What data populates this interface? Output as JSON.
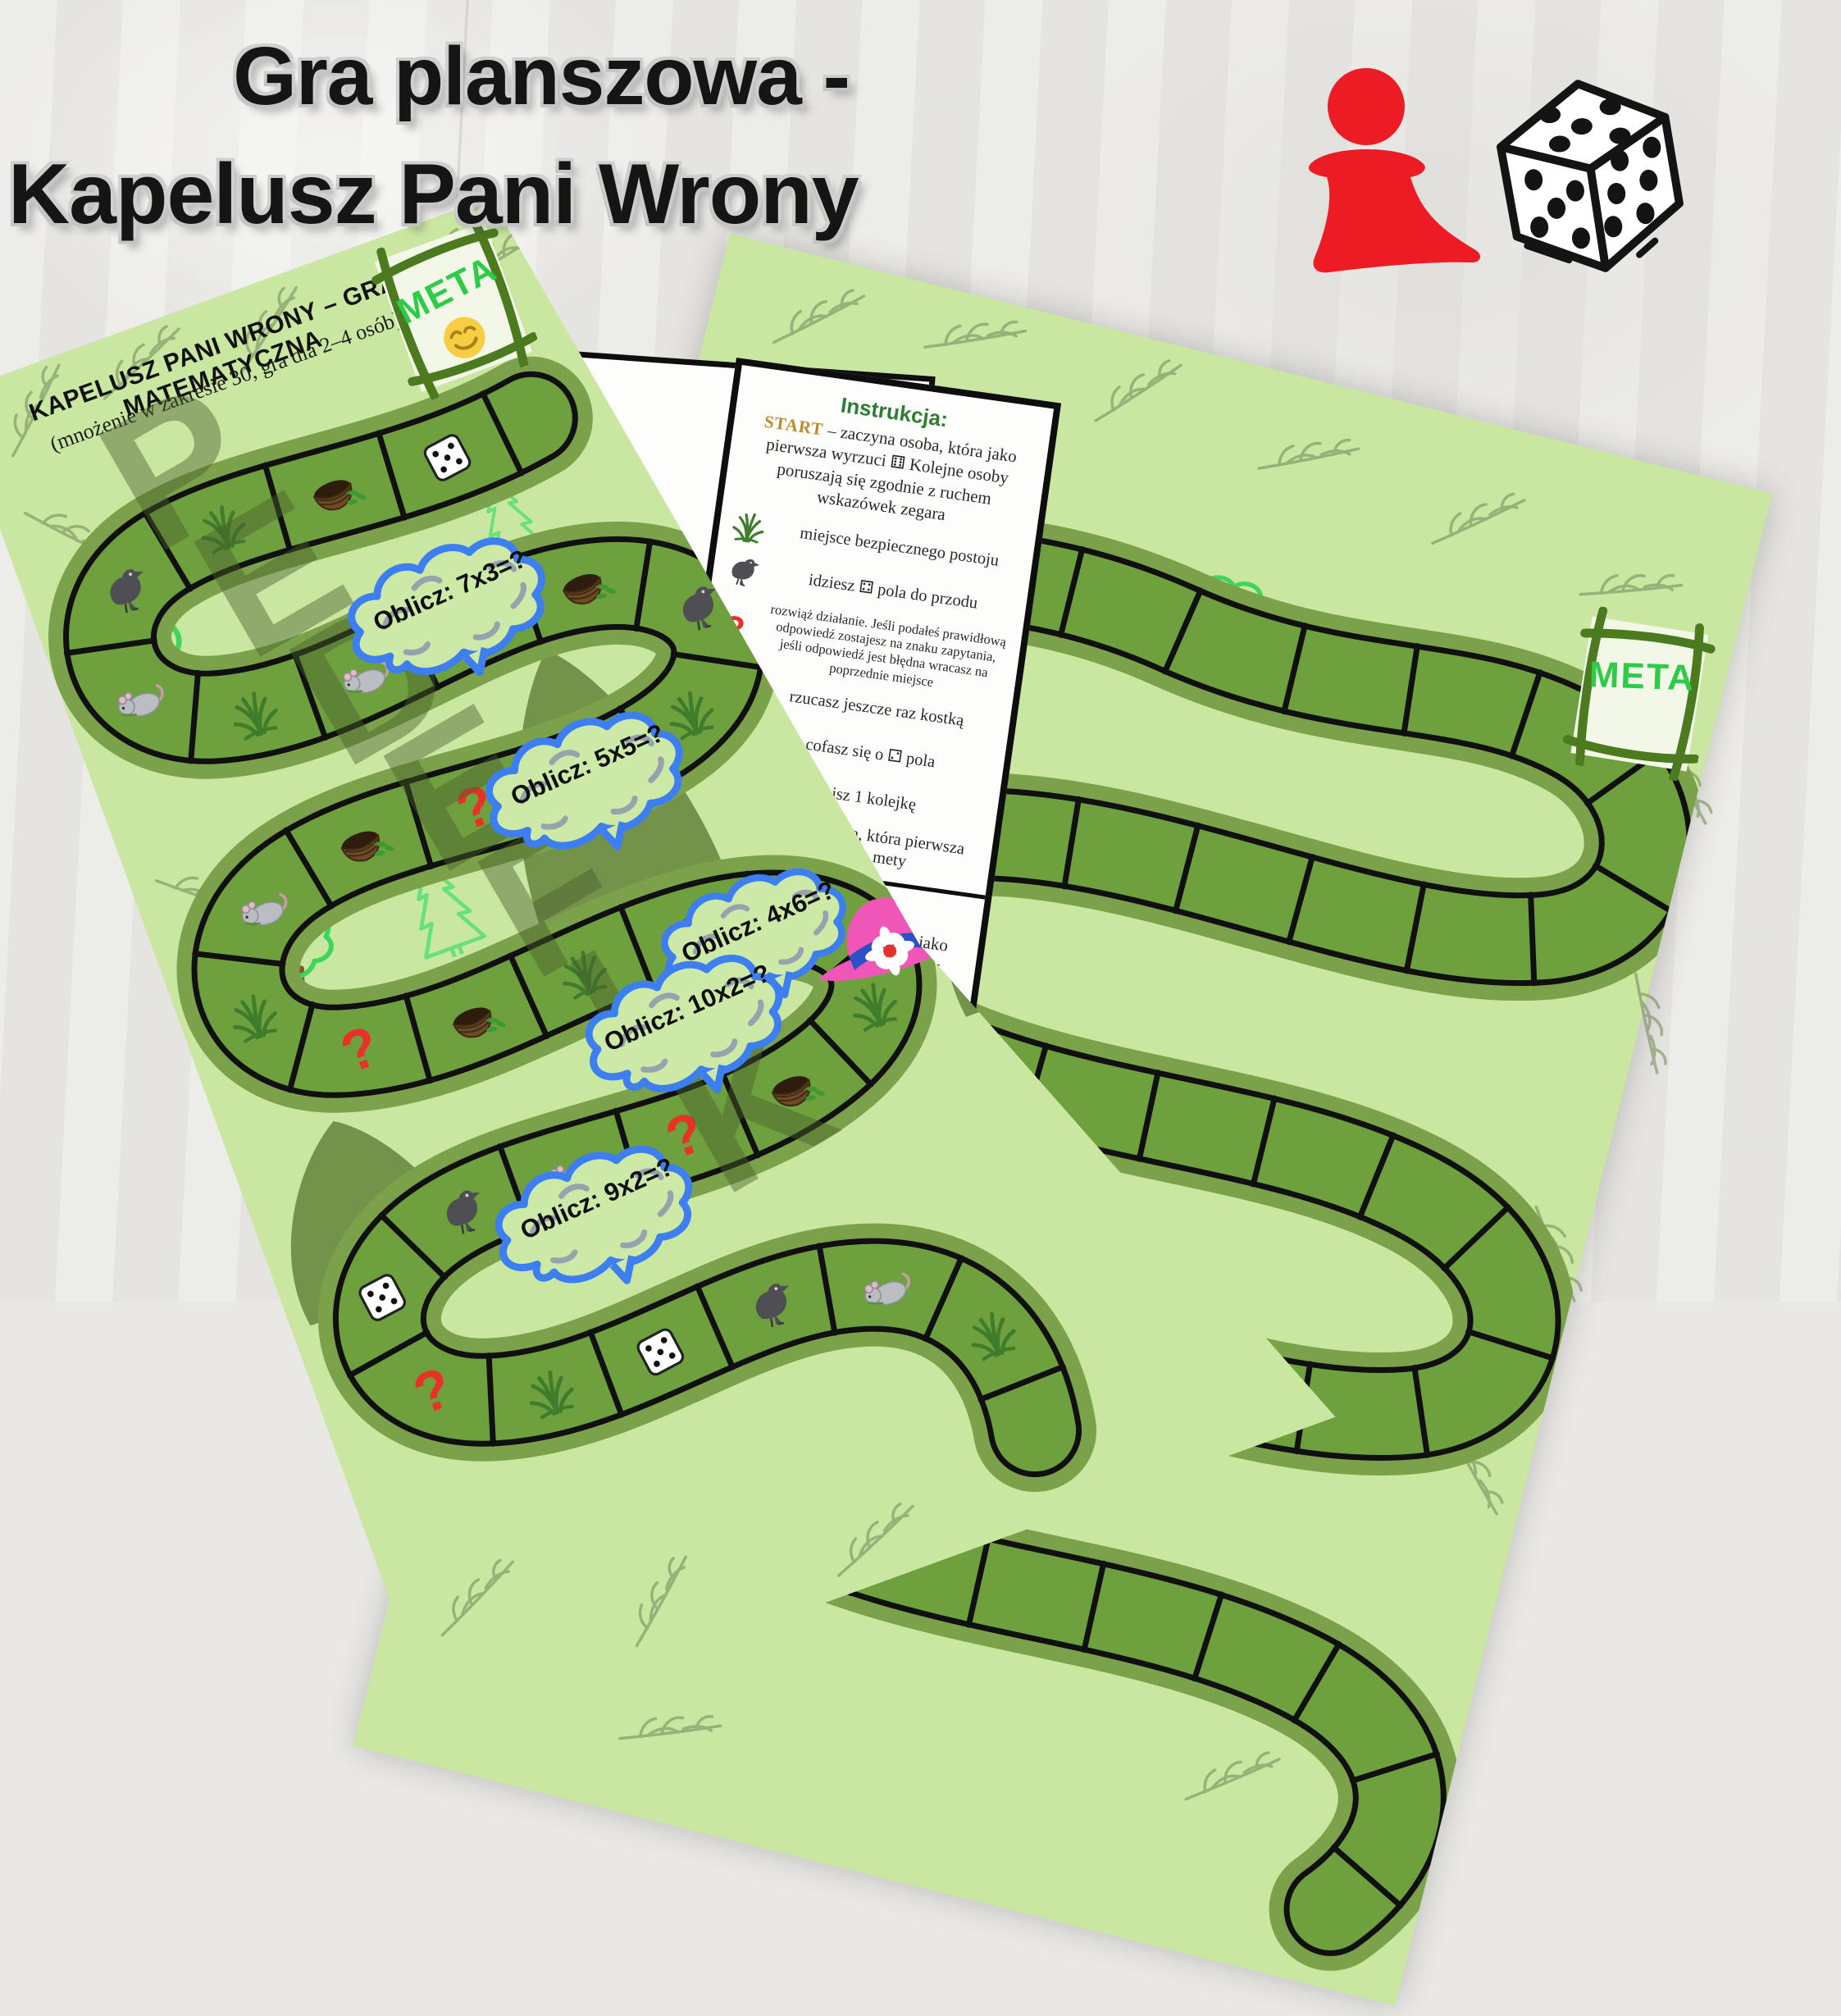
{
  "title": {
    "line1": "Gra planszowa  -",
    "line2": "Kapelusz Pani Wrony"
  },
  "top_icons": {
    "pawn": "red-game-pawn",
    "dice": "black-white-dice-cube"
  },
  "board_left": {
    "title": "KAPELUSZ PANI WRONY – GRA MATEMATYCZNA",
    "subtitle": "(mnożenie w zakresie 30, gra dla 2–4 osób)",
    "meta_label": "META",
    "meta_smiley": true,
    "watermark_letters": [
      "P",
      "E",
      "D",
      "E",
      "F",
      "I",
      "K"
    ],
    "clouds": [
      {
        "text": "Oblicz: 7x3=?"
      },
      {
        "text": "Oblicz: 5x5=?"
      },
      {
        "text": "Oblicz: 4x6=?"
      },
      {
        "text": "Oblicz: 10x2=?"
      },
      {
        "text": "Oblicz: 9x2=?"
      }
    ],
    "cells": [
      "dice",
      "nest",
      "grass",
      "crow",
      "mouse",
      "grass",
      "mouse",
      "grass",
      "nest",
      "crow",
      "grass",
      "dice",
      "question",
      "nest",
      "mouse",
      "grass",
      "question",
      "nest",
      "grass",
      "crow",
      "mouse",
      "grass",
      "nest",
      "question",
      "mouse",
      "crow",
      "dice",
      "question",
      "grass",
      "dice",
      "crow",
      "mouse",
      "grass"
    ],
    "hat": "pink-hat-with-blue-band-and-daisy"
  },
  "board_right": {
    "meta_label": "META",
    "cells_empty": 40
  },
  "instruction_sheet": {
    "heading": "Instrukcja:",
    "start_label": "START",
    "start_text": "– zaczyna osoba, która jako pierwsza wyrzuci ⚅  Kolejne osoby poruszają się zgodnie z ruchem wskazówek zegara",
    "rules": [
      {
        "icon": "grass",
        "text": "miejsce bezpiecznego postoju",
        "small": false
      },
      {
        "icon": "crow",
        "text": "idziesz ⚃ pola do przodu",
        "small": false
      },
      {
        "icon": "question",
        "text": "rozwiąż działanie. Jeśli podałeś prawidłową odpowiedź zostajesz na znaku zapytania, jeśli odpowiedź jest błędna wracasz na poprzednie miejsce",
        "small": true
      },
      {
        "icon": "dice",
        "text": "rzucasz jeszcze raz kostką",
        "small": false
      },
      {
        "icon": "mouse",
        "text": "cofasz się o ⚁ pola",
        "small": false
      },
      {
        "icon": "nest",
        "text": "stoisz 1 kolejkę",
        "small": false
      },
      {
        "icon": "hat",
        "text": "wygrywa osoba, która pierwsza dotrze do mety",
        "small": false
      }
    ]
  },
  "sheet_back_fragments": {
    "line1": "pierwsza",
    "line2": "zgodnie"
  },
  "colors": {
    "background": "#e9e8e5",
    "board_green": "#c9e7a1",
    "track_square_green": "#6fa03e",
    "track_band_green": "#7ba24a",
    "title_black": "#151515",
    "meta_green": "#2ecb49",
    "cloud_blue": "#3d7ef0",
    "question_red": "#e83228",
    "hat_pink": "#f055b8",
    "hat_band_blue": "#2b50c8",
    "pawn_red": "#ed1c24",
    "instruction_green": "#2e7d32",
    "start_gold": "#bd8a2e"
  }
}
